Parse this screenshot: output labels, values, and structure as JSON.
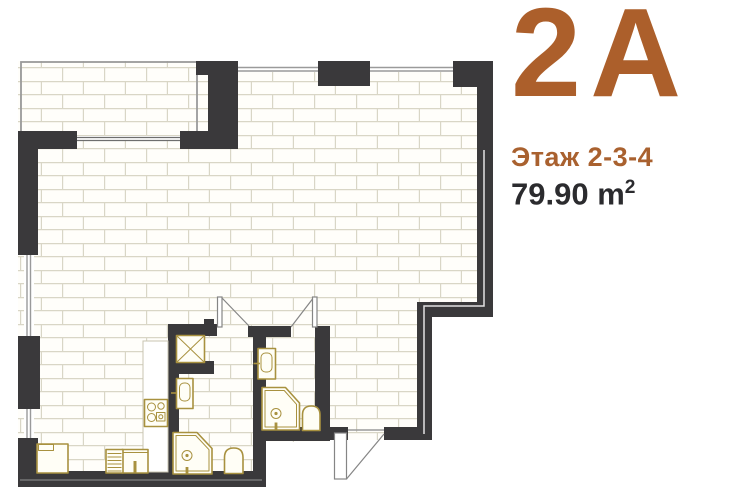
{
  "listing": {
    "unit_label": "2A",
    "floor_label": "Этаж 2-3-4",
    "area_label": "79.90 m",
    "area_superscript": "2"
  },
  "colors": {
    "accent_brown": "#AC5F2B",
    "floor_text_brown": "#A9612F",
    "area_text": "#2B2B2E",
    "wall_dark": "#3A393B",
    "fixture_gold": "#A8913F",
    "grout": "#D9D6C6",
    "floor_white": "#FFFEFA",
    "line_gray": "#9A9A9A",
    "page_bg": "#FFFFFF"
  },
  "floorplan": {
    "icons": [
      "balcony-glazing",
      "window",
      "vent-shaft-icon",
      "washbasin-icon",
      "corner-shower-icon",
      "toilet-icon",
      "stove-icon",
      "kitchen-sink-icon",
      "dishwasher-icon",
      "cabinet-icon",
      "door-swing-icon",
      "entrance-door-icon"
    ]
  }
}
